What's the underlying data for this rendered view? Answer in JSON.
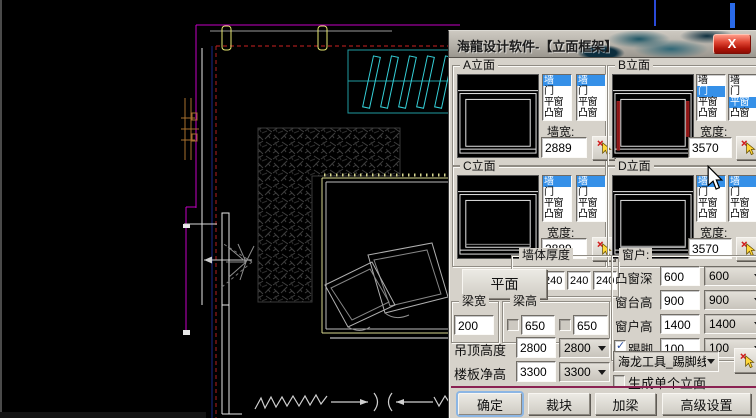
{
  "window": {
    "title": "海龍设计软件-【立面框架】",
    "close_label": "X"
  },
  "colors": {
    "selection_blue": "#3590e8",
    "separator_maroon": "#8a2252",
    "dialog_bg": "#d6d2ca",
    "close_button_red": "#c41e14",
    "cad_magenta": "#c400c4",
    "cad_cyan": "#35d0d8",
    "cad_yellow": "#e8e870"
  },
  "list_items": [
    "墙",
    "门",
    "平窗",
    "凸窗"
  ],
  "elevations": [
    {
      "label": "A立面",
      "width_label": "墙宽:",
      "width_value": "2889",
      "list1_selected": 0,
      "list2_selected": 0
    },
    {
      "label": "B立面",
      "width_label": "宽度:",
      "width_value": "3570",
      "list1_selected": 1,
      "list2_selected": 2
    },
    {
      "label": "C立面",
      "width_label": "宽度:",
      "width_value": "2889",
      "list1_selected": 0,
      "list2_selected": 0
    },
    {
      "label": "D立面",
      "width_label": "宽度:",
      "width_value": "3570",
      "list1_selected": 0,
      "list2_selected": 0
    }
  ],
  "wall_thickness": {
    "label": "墙体厚度",
    "values": [
      "120",
      "240",
      "240",
      "240"
    ]
  },
  "plan_button_label": "平面",
  "beam_width": {
    "label": "梁宽",
    "value": "200"
  },
  "beam_height": {
    "label": "梁高",
    "value1": "650",
    "value2": "650"
  },
  "ceiling_height": {
    "label": "吊顶高度",
    "value": "2800",
    "dropdown": "2800"
  },
  "floor_height": {
    "label": "楼板净高",
    "value": "3300",
    "dropdown": "3300"
  },
  "window_group": {
    "label": "窗户:",
    "bay_depth": {
      "label": "凸窗深",
      "value": "600",
      "dropdown": "600"
    },
    "sill_height": {
      "label": "窗台高",
      "value": "900",
      "dropdown": "900"
    },
    "window_height": {
      "label": "窗户高",
      "value": "1400",
      "dropdown": "1400"
    },
    "skirting": {
      "label": "踢脚",
      "value": "100",
      "dropdown": "100",
      "checked": true
    }
  },
  "tool_dropdown": {
    "value": "海龙工具_踢脚线"
  },
  "generate_single": {
    "label": "生成单个立面",
    "checked": false
  },
  "action_buttons": [
    "确定",
    "裁块",
    "加梁",
    "高级设置"
  ]
}
